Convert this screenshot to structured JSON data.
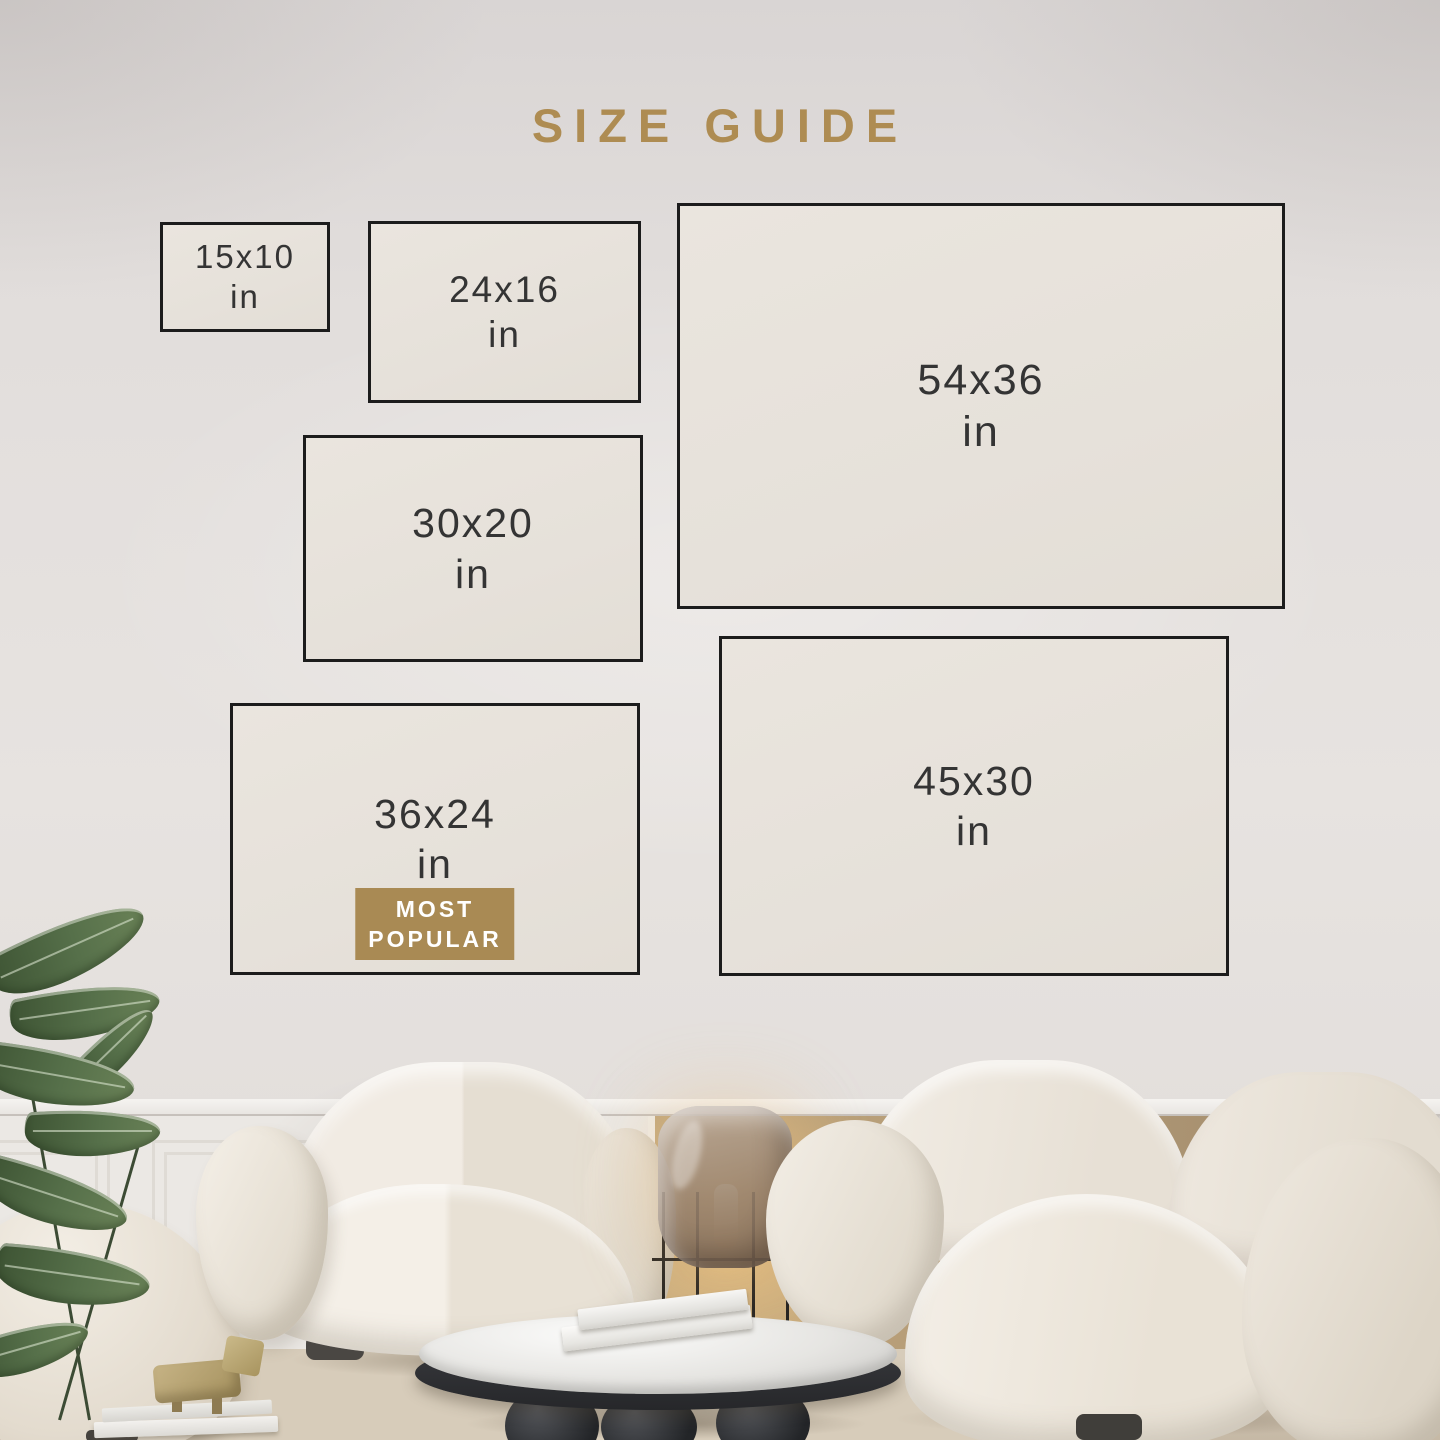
{
  "title": "SIZE GUIDE",
  "colors": {
    "accent_gold": "#ae8c52",
    "badge_gold": "#a98a54",
    "frame_border": "#1c1c1c",
    "frame_fill": "#e8e3dc",
    "wall": "#e4e0dd",
    "label_text": "#343434",
    "badge_text": "#ffffff"
  },
  "sizes": [
    {
      "label": "15x10",
      "unit": "in"
    },
    {
      "label": "24x16",
      "unit": "in"
    },
    {
      "label": "30x20",
      "unit": "in"
    },
    {
      "label": "54x36",
      "unit": "in"
    },
    {
      "label": "36x24",
      "unit": "in",
      "most_popular": true
    },
    {
      "label": "45x30",
      "unit": "in"
    }
  ],
  "badge": {
    "line1": "MOST",
    "line2": "POPULAR"
  }
}
